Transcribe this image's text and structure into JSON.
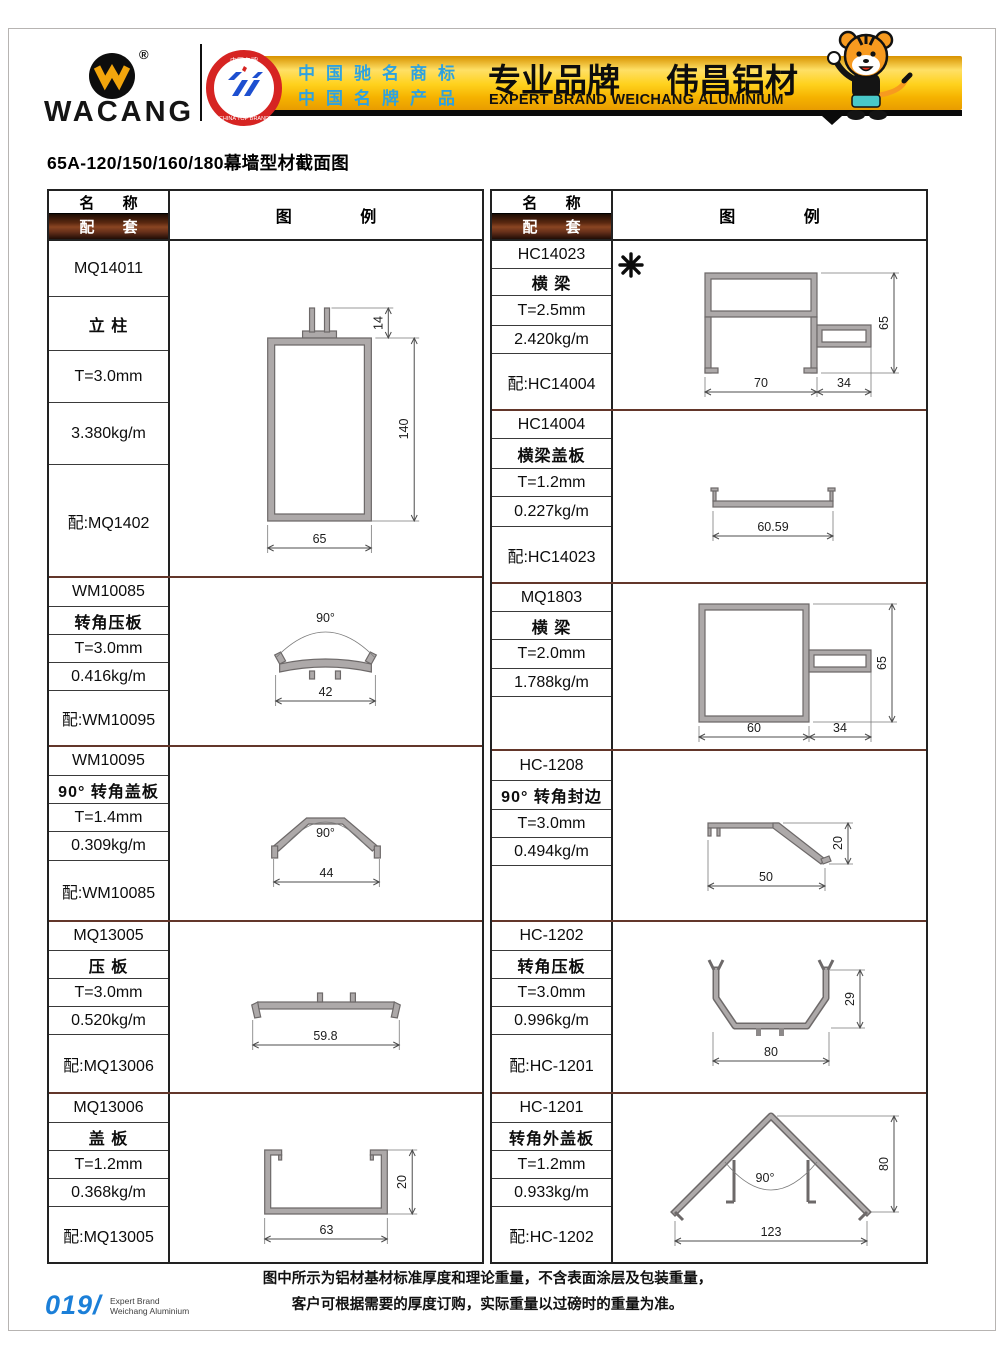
{
  "header": {
    "brand": "WACANG",
    "registered": "®",
    "badge_top": "中国名牌",
    "badge_bottom": "CHINA TOP BRAND",
    "claim_line1": "中国驰名商标",
    "claim_line2": "中国名牌产品",
    "slogan_cn_left": "专业品牌",
    "slogan_cn_right": "伟昌铝材",
    "slogan_en": "EXPERT BRAND WEICHANG ALUMINIUM"
  },
  "page_title": "65A-120/150/160/180幕墙型材截面图",
  "table_headers": {
    "name": "名 称",
    "match": "配 套",
    "legend": "图 例"
  },
  "tables": {
    "left": {
      "blocks": [
        {
          "code": "MQ14011",
          "name": "立 柱",
          "spec": "T=3.0mm",
          "weight": "3.380kg/m",
          "match": "配:MQ1402",
          "dims": {
            "w": "65",
            "h": "140",
            "t": "14"
          }
        },
        {
          "code": "WM10085",
          "name": "转角压板",
          "spec": "T=3.0mm",
          "weight": "0.416kg/m",
          "match": "配:WM10095",
          "dims": {
            "w": "42",
            "angle": "90°"
          }
        },
        {
          "code": "WM10095",
          "name": "90° 转角盖板",
          "spec": "T=1.4mm",
          "weight": "0.309kg/m",
          "match": "配:WM10085",
          "dims": {
            "w": "44",
            "angle": "90°"
          }
        },
        {
          "code": "MQ13005",
          "name": "压 板",
          "spec": "T=3.0mm",
          "weight": "0.520kg/m",
          "match": "配:MQ13006",
          "dims": {
            "w": "59.8"
          }
        },
        {
          "code": "MQ13006",
          "name": "盖 板",
          "spec": "T=1.2mm",
          "weight": "0.368kg/m",
          "match": "配:MQ13005",
          "dims": {
            "w": "63",
            "h": "20"
          }
        }
      ]
    },
    "right": {
      "blocks": [
        {
          "code": "HC14023",
          "name": "横 梁",
          "spec": "T=2.5mm",
          "weight": "2.420kg/m",
          "match": "配:HC14004",
          "marker": "✳",
          "dims": {
            "w1": "70",
            "w2": "34",
            "h": "65"
          }
        },
        {
          "code": "HC14004",
          "name": "横梁盖板",
          "spec": "T=1.2mm",
          "weight": "0.227kg/m",
          "match": "配:HC14023",
          "dims": {
            "w": "60.59"
          }
        },
        {
          "code": "MQ1803",
          "name": "横 梁",
          "spec": "T=2.0mm",
          "weight": "1.788kg/m",
          "match": "",
          "dims": {
            "w1": "60",
            "w2": "34",
            "h": "65"
          }
        },
        {
          "code": "HC-1208",
          "name": "90° 转角封边",
          "spec": "T=3.0mm",
          "weight": "0.494kg/m",
          "match": "",
          "dims": {
            "w": "50",
            "h": "20"
          }
        },
        {
          "code": "HC-1202",
          "name": "转角压板",
          "spec": "T=3.0mm",
          "weight": "0.996kg/m",
          "match": "配:HC-1201",
          "dims": {
            "w": "80",
            "h": "29"
          }
        },
        {
          "code": "HC-1201",
          "name": "转角外盖板",
          "spec": "T=1.2mm",
          "weight": "0.933kg/m",
          "match": "配:HC-1202",
          "dims": {
            "w": "123",
            "h": "80",
            "angle": "90°"
          }
        }
      ]
    }
  },
  "footer": {
    "note_line1": "图中所示为铝材基材标准厚度和理论重量，不含表面涂层及包装重量，",
    "note_line2": "客户可根据需要的厚度订购，实际重量以过磅时的重量为准。",
    "page_number": "019/",
    "page_label_line1": "Expert Brand",
    "page_label_line2": "Weichang Aluminium"
  },
  "colors": {
    "banner_gold": "#FFD21E",
    "banner_orange": "#E89C00",
    "maroon_separator": "#63362A",
    "match_header_brown": "#8A4522",
    "badge_red": "#D62422",
    "claims_blue": "#2EA2E0",
    "page_number_blue": "#1B7FD8",
    "profile_fill": "#ADA9A9",
    "profile_stroke": "#6D6969"
  }
}
